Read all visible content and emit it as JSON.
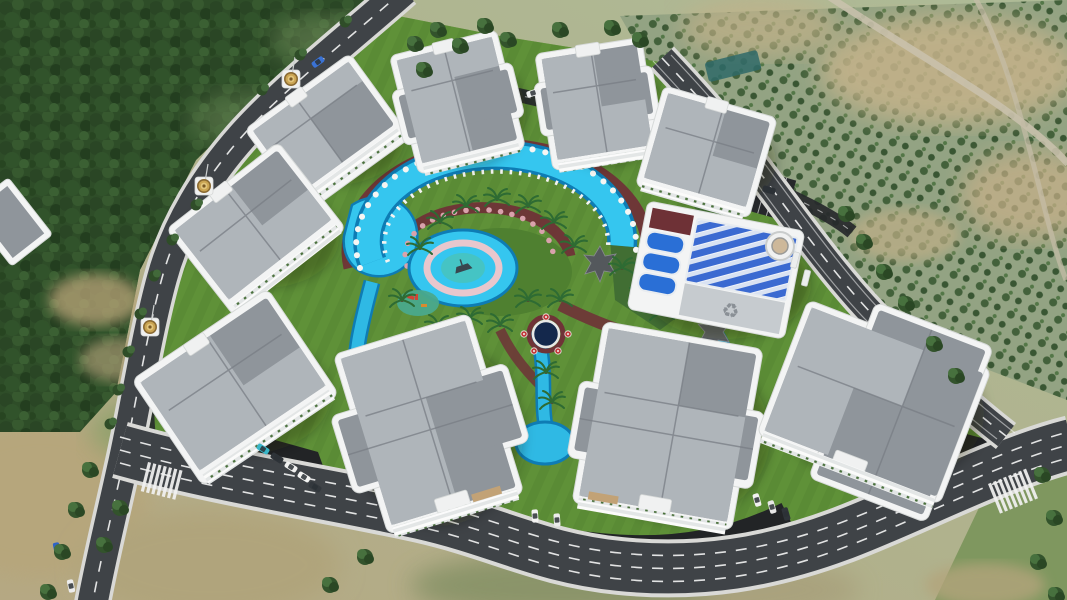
{
  "image": {
    "kind": "3D aerial architectural rendering",
    "subject": "residential complex with central circular pool courtyard, ring roads, forest and orchard surroundings",
    "text_visible": false
  },
  "complex": {
    "residential_blocks": 9,
    "amenity_buildings": 1,
    "corner_domes": 3,
    "amenities": [
      "crescent lazy-river pool",
      "children's pool",
      "sun lounger ring",
      "white pool umbrellas",
      "pink garden umbrellas",
      "palm gardens",
      "fountain plaza with red umbrellas",
      "playground",
      "shade canopies",
      "indoor pool with blue lanes",
      "rooftop solar array",
      "surface parking"
    ],
    "roads": {
      "perimeter_roads": 3,
      "crosswalks": 2,
      "lane_marking": "white dashed"
    },
    "vehicles": {
      "cars_on_roads": 4,
      "cars_parked": 11
    },
    "landscape": [
      "dense forest northwest",
      "orchard tree rows east",
      "dirt tracks",
      "striped mowed lawns",
      "tan scrub hills southwest"
    ]
  },
  "icons": {
    "recycle": "♻"
  },
  "colors": {
    "pool_water": "#35c6ef",
    "pool_edge": "#0e7cb4",
    "lawn": "#5f9138",
    "asphalt": "#3f4347",
    "roof_gray": "#8f959b",
    "wall_white": "#f3f4f4",
    "deck_maroon": "#6f3337",
    "solar_blue": "#3b6ad1",
    "forest_green": "#2e4d28",
    "dome_gold": "#caa452"
  }
}
